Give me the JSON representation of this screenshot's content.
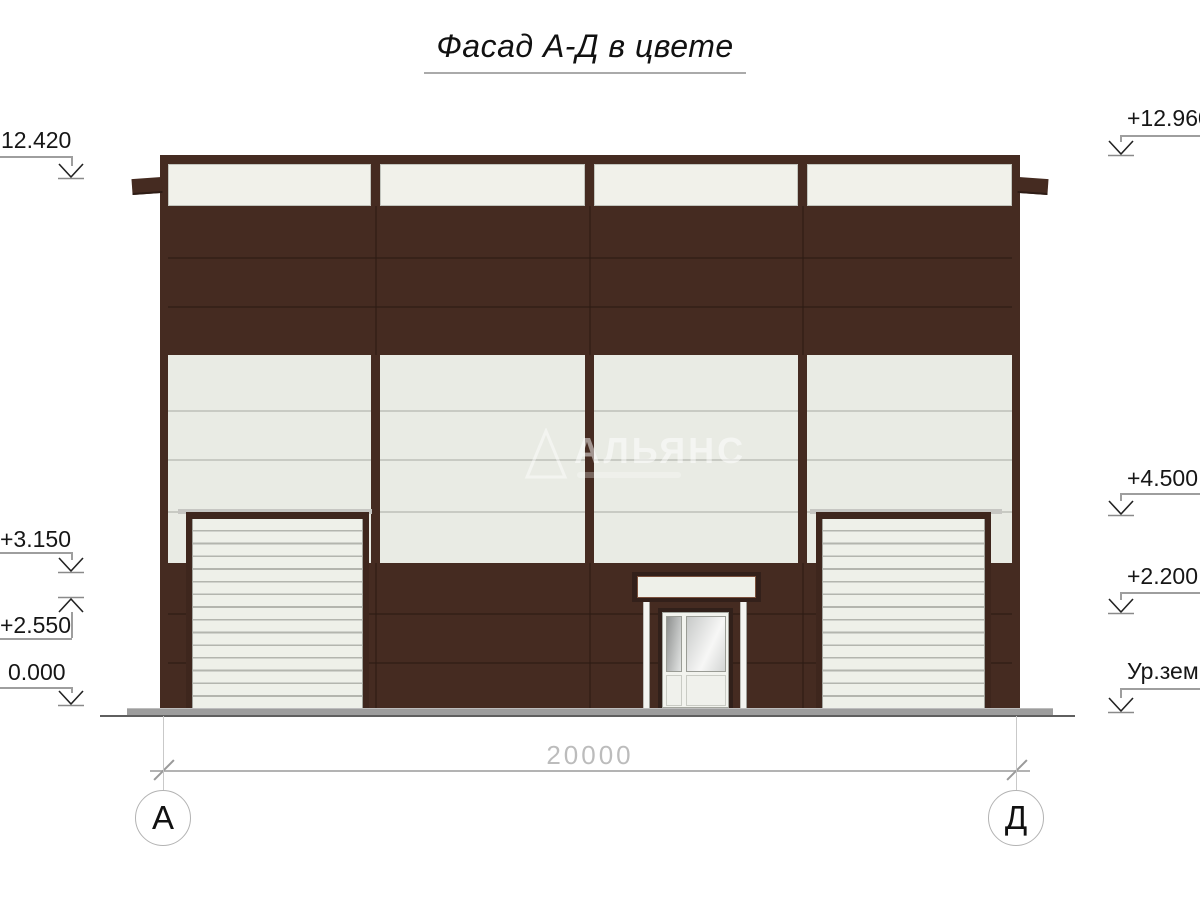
{
  "title": "Фасад А-Д в цвете",
  "watermark": "АЛЬЯНС",
  "dimension": {
    "total_label": "20000"
  },
  "axis_bubbles": {
    "left": "А",
    "right": "Д"
  },
  "marks": {
    "left": [
      {
        "label": "12.420",
        "type": "down"
      },
      {
        "label": "+3.150",
        "type": "down"
      },
      {
        "label": "+2.550",
        "type": "up"
      },
      {
        "label": "0.000",
        "type": "down"
      }
    ],
    "right": [
      {
        "label": "+12.960",
        "type": "down"
      },
      {
        "label": "+4.500",
        "type": "down"
      },
      {
        "label": "+2.200",
        "type": "down"
      },
      {
        "label": "Ур.зем.",
        "type": "down"
      }
    ]
  },
  "colors": {
    "brown": "#452b21",
    "brown_seam": "#2e1c14",
    "brown_dark": "#31201a",
    "panel": "#e9ebe4",
    "panel_seam": "#c8cac3",
    "window": "#f1f1ea",
    "slat": "#eef0e9",
    "slat_line": "#b3b5ae",
    "lintel": "#c6c6c2",
    "plinth": "#9d9d9d",
    "ink": "#1a1a1a",
    "dim_gray": "#b3b3b3"
  }
}
